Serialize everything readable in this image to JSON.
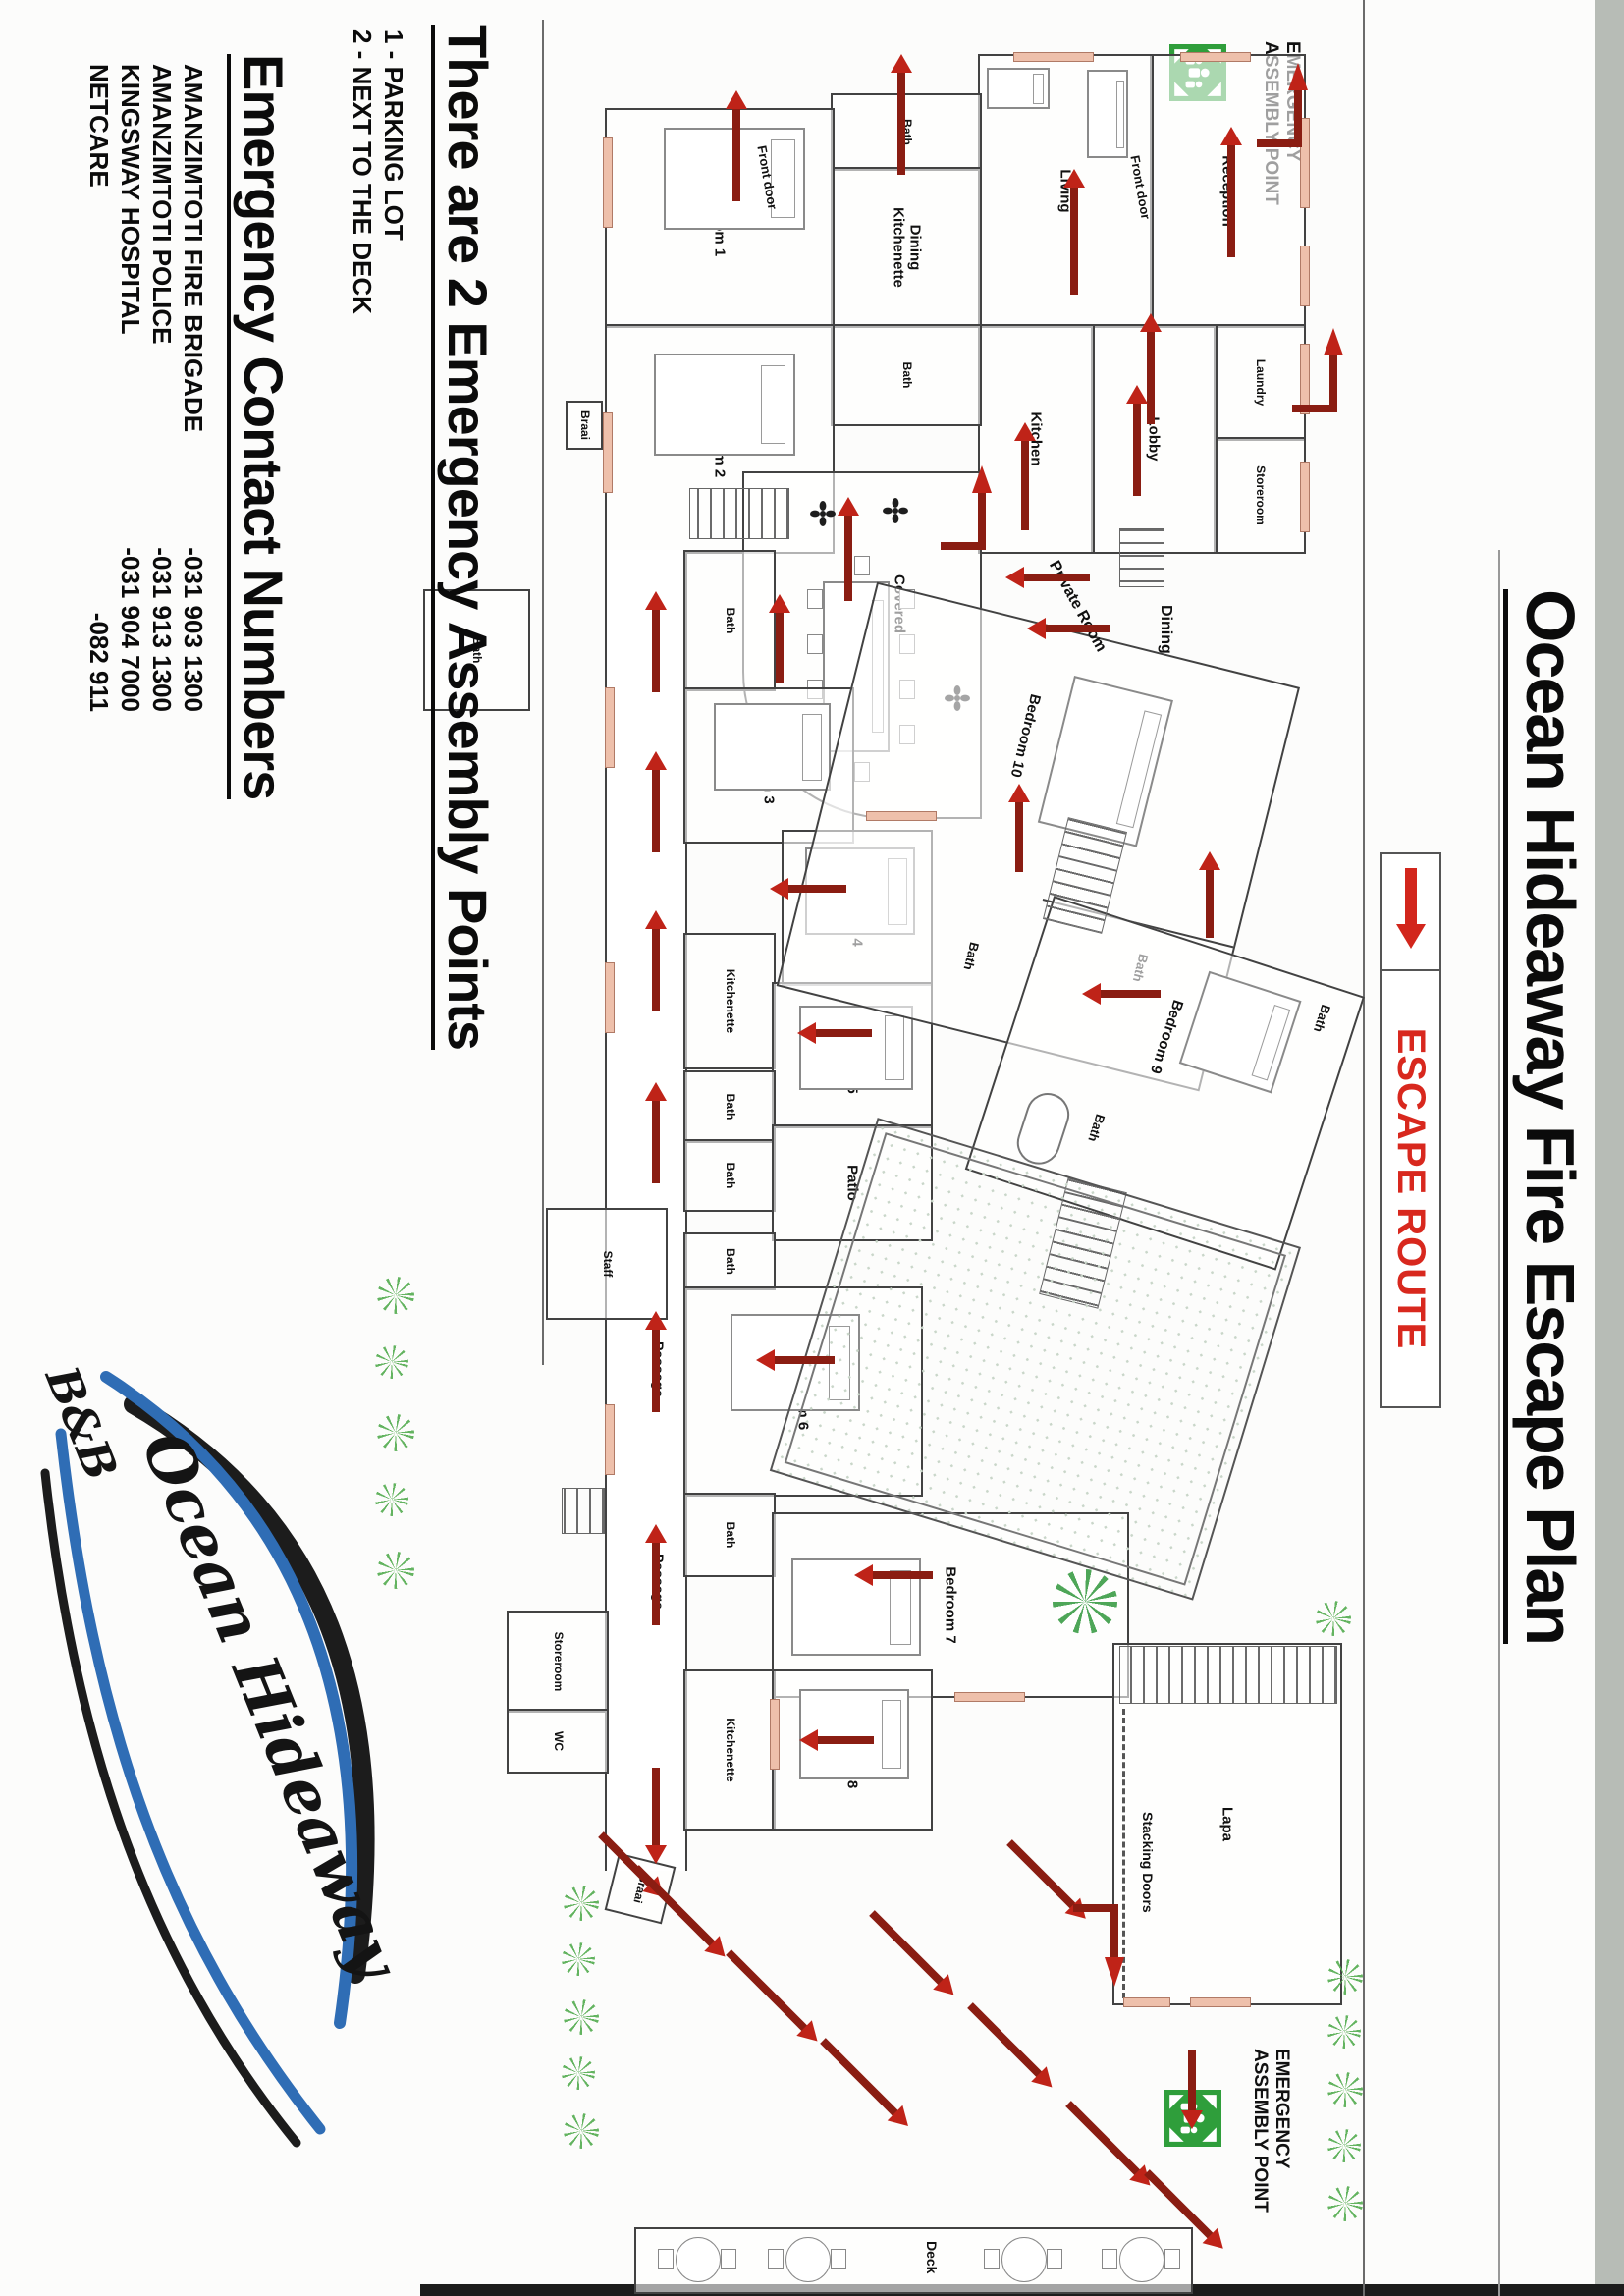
{
  "page": {
    "title": "Ocean Hideaway Fire Escape Plan"
  },
  "legend": {
    "label": "ESCAPE ROUTE"
  },
  "assembly_point": {
    "line1": "EMERGENCY",
    "line2": "ASSEMBLY POINT"
  },
  "info": {
    "assembly_heading": "There are 2 Emergency Assembly Points",
    "assembly_points": [
      "1 - PARKING LOT",
      "2 - NEXT TO THE DECK"
    ],
    "contacts_heading": "Emergency Contact Numbers",
    "contacts": [
      {
        "name": "AMANZIMTOTI FIRE BRIGADE",
        "number": "-031 903 1300"
      },
      {
        "name": "AMANZIMTOTI POLICE",
        "number": "-031 913 1300"
      },
      {
        "name": "KINGSWAY HOSPITAL",
        "number": "-031 904 7000"
      },
      {
        "name": "NETCARE",
        "number": "-082 911"
      }
    ]
  },
  "logo": {
    "name": "Ocean Hideaway",
    "sub": "B&B"
  },
  "rooms": {
    "bedroom1": "Bedroom 1",
    "bedroom2": "Bedroom 2",
    "bedroom3": "Bedroom 3",
    "bedroom4": "Bedroom 4",
    "bedroom5": "Bedroom 5",
    "bedroom6": "Bedroom 6",
    "bedroom7": "Bedroom 7",
    "bedroom8": "Bedroom 8",
    "bedroom9": "Bedroom 9",
    "bedroom10": "Bedroom 10",
    "bath": "Bath",
    "wc": "WC",
    "kitchen": "Kitchen",
    "kitchenette": "Kitchenette",
    "living": "Living",
    "reception": "Reception",
    "laundry": "Laundry",
    "lobby": "Lobby",
    "storeroom": "Storeroom",
    "dining": "Dining",
    "dining_kitchenette": "Dining Kitchenette",
    "covered_patio": "Covered Patio",
    "patio": "Patio",
    "passage": "Passage",
    "staff": "Staff",
    "front_door": "Front door",
    "private_room": "Private Room",
    "braai": "Braai",
    "lapa": "Lapa",
    "stacking_doors": "Stacking Doors",
    "deck": "Deck"
  }
}
